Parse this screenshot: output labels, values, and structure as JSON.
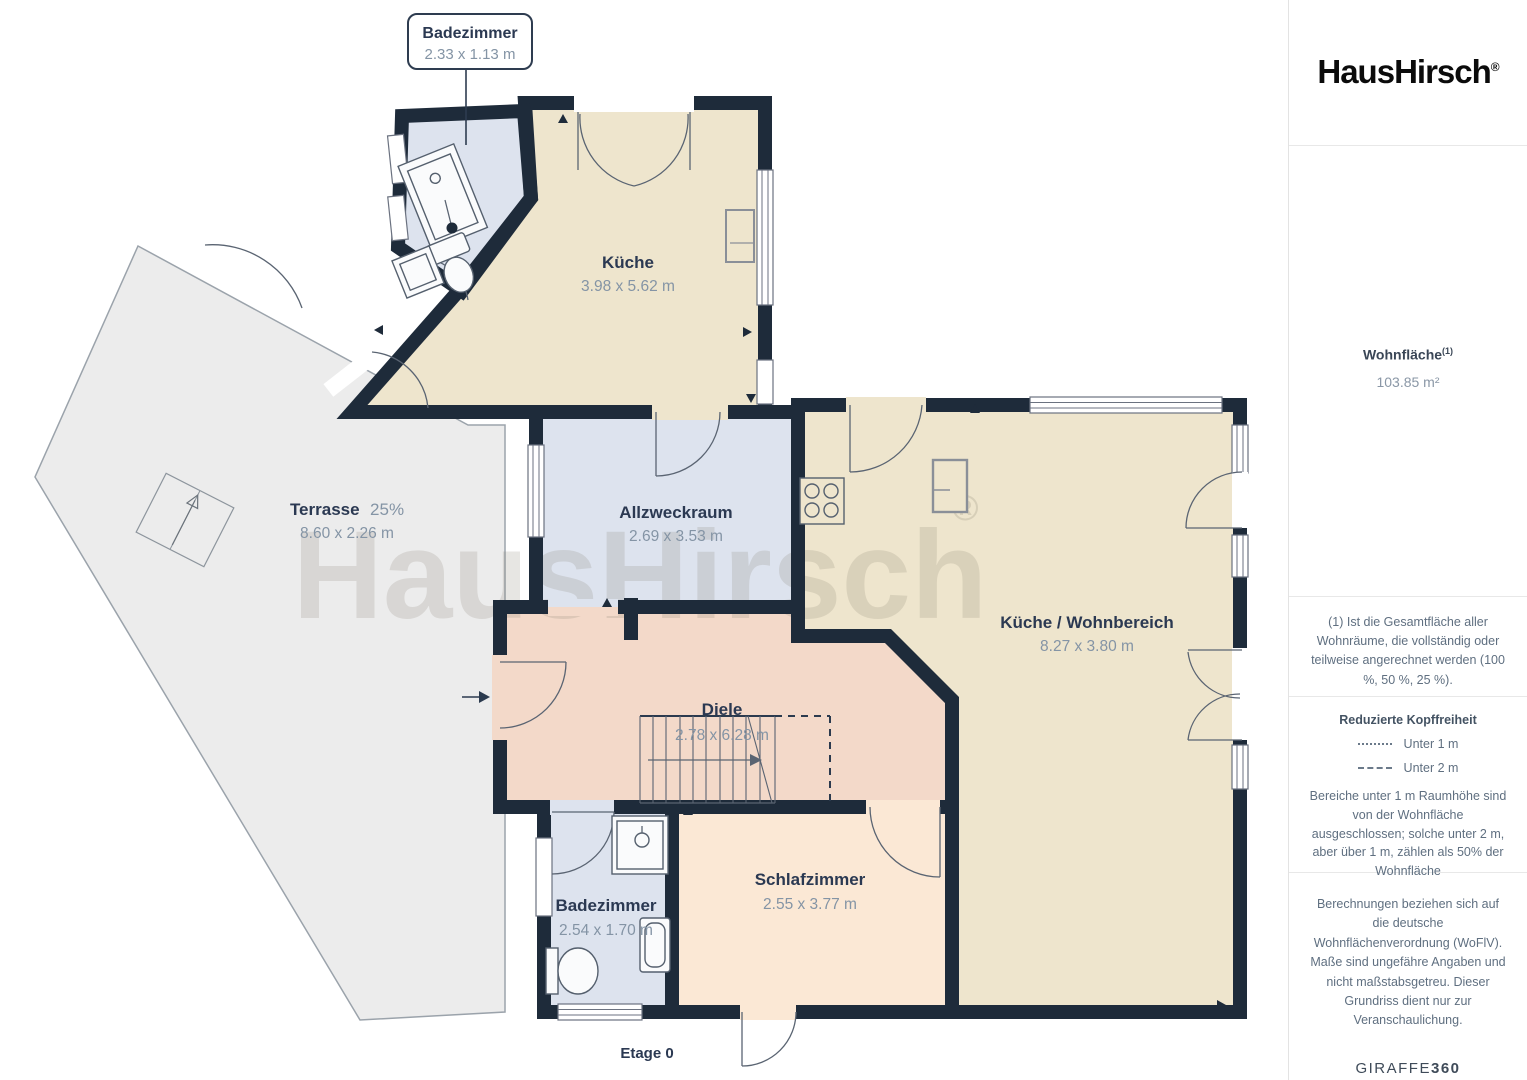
{
  "branding": {
    "logo": "HausHirsch",
    "registered": "®"
  },
  "watermark": {
    "text": "HausHirsch",
    "registered": "®"
  },
  "floor": {
    "label": "Etage 0"
  },
  "callout": {
    "label": "Badezimmer",
    "dims": "2.33 x 1.13 m"
  },
  "rooms": {
    "kueche": {
      "label": "Küche",
      "dims": "3.98 x 5.62 m"
    },
    "terrasse": {
      "label": "Terrasse",
      "percent": "25%",
      "dims": "8.60 x 2.26 m"
    },
    "allzweckraum": {
      "label": "Allzweckraum",
      "dims": "2.69 x 3.53 m"
    },
    "wohnbereich": {
      "label": "Küche / Wohnbereich",
      "dims": "8.27 x 3.80 m"
    },
    "diele": {
      "label": "Diele",
      "dims": "2.78 x 6.28 m"
    },
    "badezimmer": {
      "label": "Badezimmer",
      "dims": "2.54 x 1.70 m"
    },
    "schlafzimmer": {
      "label": "Schlafzimmer",
      "dims": "2.55 x 3.77 m"
    }
  },
  "sidebar": {
    "area": {
      "title": "Wohnfläche",
      "footnote_marker": "(1)",
      "value": "103.85 m²"
    },
    "footnote": "(1) Ist die Gesamtfläche aller Wohnräume, die vollständig oder teilweise angerechnet werden (100 %, 50 %, 25 %).",
    "headroom": {
      "title": "Reduzierte Kopffreiheit",
      "legend": [
        {
          "style": "dotted",
          "label": "Unter 1 m"
        },
        {
          "style": "dashed",
          "label": "Unter 2 m"
        }
      ],
      "note": "Bereiche unter 1 m Raumhöhe sind von der Wohnfläche ausgeschlossen; solche unter 2 m, aber über 1 m, zählen als 50% der Wohnfläche"
    },
    "disclaimer": "Berechnungen beziehen sich auf die deutsche Wohnflächenverordnung (WoFlV). Maße sind ungefähre Angaben und nicht maßstabsgetreu. Dieser Grundriss dient nur zur Veranschaulichung.",
    "footer_brand": {
      "name": "GIRAFFE",
      "suffix": "360"
    }
  },
  "colors": {
    "wall": "#1e2b3a",
    "room_beige": "#eee5cd",
    "room_blue": "#dde3ee",
    "room_pink": "#f3d9c9",
    "room_peach": "#fbe8d5",
    "terrace": "#ececec",
    "label_text": "#2b3952",
    "dims_text": "#8494a5"
  }
}
